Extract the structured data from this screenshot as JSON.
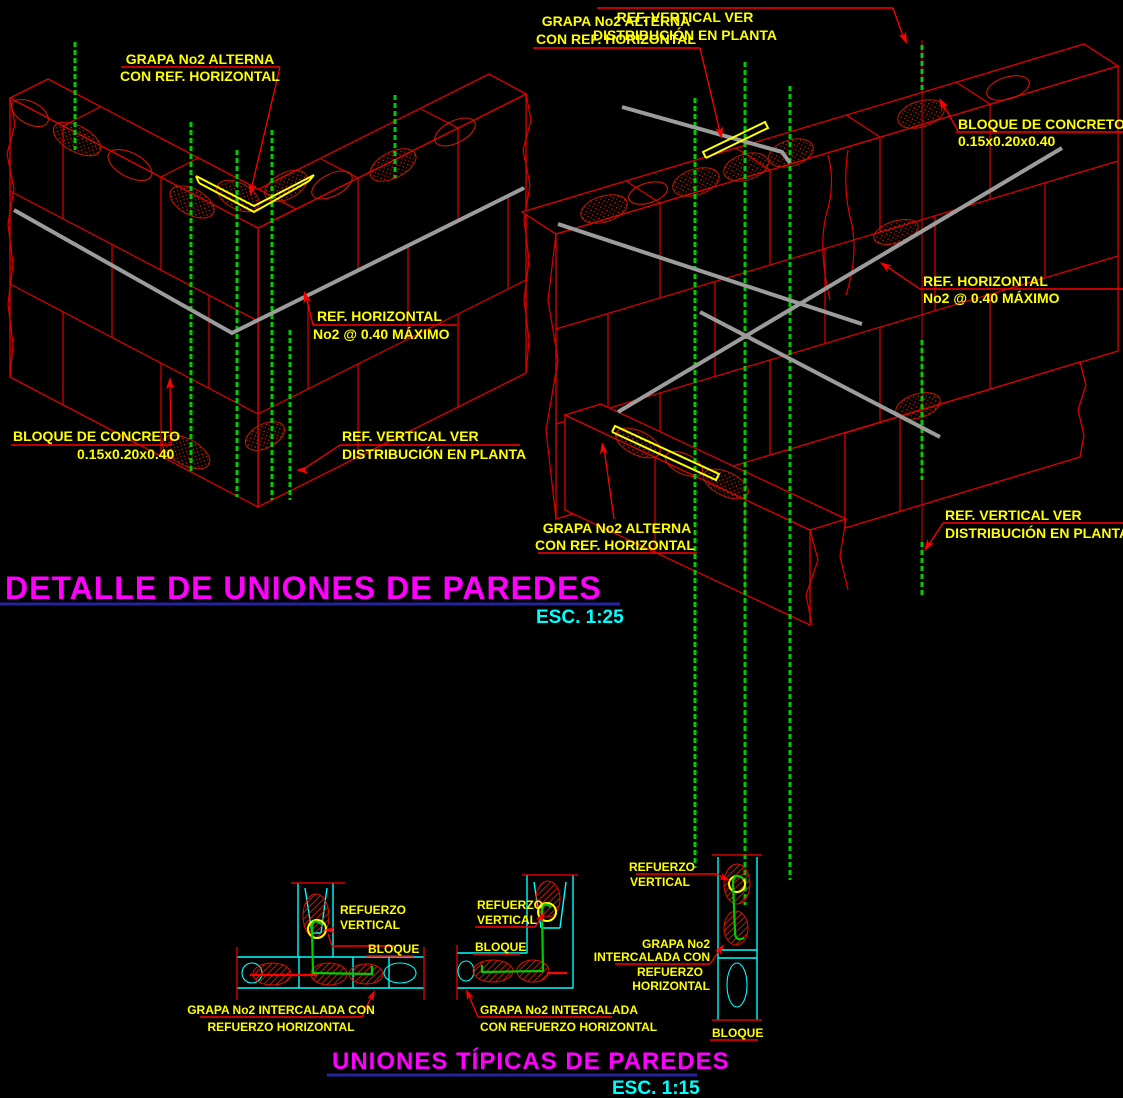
{
  "titles": {
    "detail": {
      "text": "DETALLE DE UNIONES DE PAREDES",
      "scale": "ESC. 1:25"
    },
    "typical": {
      "text": "UNIONES TÍPICAS DE PAREDES",
      "scale": "ESC. 1:15"
    }
  },
  "detail_a": {
    "name": "corner wall union isometric detail",
    "labels": {
      "grapa": {
        "l1": "GRAPA No2 ALTERNA",
        "l2": "CON REF. HORIZONTAL"
      },
      "ref_h": {
        "l1": "REF. HORIZONTAL",
        "l2": "No2 @ 0.40 MÁXIMO"
      },
      "bloque": {
        "l1": "BLOQUE DE CONCRETO",
        "l2": "0.15x0.20x0.40"
      },
      "ref_v": {
        "l1": "REF. VERTICAL VER",
        "l2": "DISTRIBUCIÓN EN PLANTA"
      }
    }
  },
  "detail_b": {
    "name": "tee wall union isometric detail",
    "labels": {
      "grapa_top": {
        "l1": "GRAPA No2 ALTERNA",
        "l2": "CON REF. HORIZONTAL"
      },
      "ref_v_top": {
        "l1": "REF. VERTICAL VER",
        "l2": "DISTRIBUCIÓN EN PLANTA"
      },
      "bloque": {
        "l1": "BLOQUE DE CONCRETO",
        "l2": "0.15x0.20x0.40"
      },
      "ref_h": {
        "l1": "REF. HORIZONTAL",
        "l2": "No2 @ 0.40 MÁXIMO"
      },
      "grapa_bottom": {
        "l1": "GRAPA No2 ALTERNA",
        "l2": "CON REF. HORIZONTAL"
      },
      "ref_v_bottom": {
        "l1": "REF. VERTICAL VER",
        "l2": "DISTRIBUCIÓN EN PLANTA"
      }
    }
  },
  "plan_tee": {
    "name": "typical tee union plan view",
    "labels": {
      "ref_v": {
        "l1": "REFUERZO",
        "l2": "VERTICAL"
      },
      "bloque": "BLOQUE",
      "grapa": {
        "l1": "GRAPA No2 INTERCALADA CON",
        "l2": "REFUERZO HORIZONTAL"
      }
    }
  },
  "plan_corner": {
    "name": "typical corner union plan view",
    "labels": {
      "ref_v": {
        "l1": "REFUERZO",
        "l2": "VERTICAL"
      },
      "bloque": "BLOQUE",
      "grapa": {
        "l1": "GRAPA No2 INTERCALADA",
        "l2": "CON REFUERZO HORIZONTAL"
      }
    }
  },
  "plan_straight": {
    "name": "typical straight wall plan view",
    "labels": {
      "ref_v": {
        "l1": "REFUERZO",
        "l2": "VERTICAL"
      },
      "grapa": {
        "l1": "GRAPA No2",
        "l2": "INTERCALADA CON",
        "l3": "REFUERZO",
        "l4": "HORIZONTAL"
      },
      "bloque": "BLOQUE"
    }
  },
  "colors": {
    "background": "#000000",
    "block_lines": "#e00000",
    "label_text": "#ffff00",
    "vertical_rebar": "#00cc00",
    "horizontal_rebar": "#9c9c9c",
    "grapa": "#ffff00",
    "plan_outline": "#00ffff",
    "title_text": "#ff00ff",
    "title_underline": "#2323a0",
    "scale_text": "#00ffff"
  }
}
